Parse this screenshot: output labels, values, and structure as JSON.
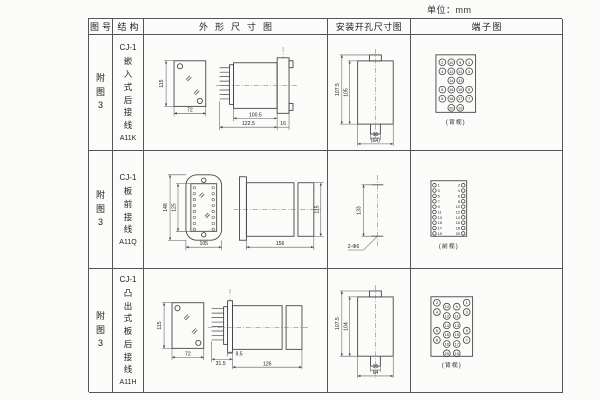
{
  "unit_label": "单位：mm",
  "table": {
    "headers": [
      "图号",
      "结构",
      "外形尺寸图",
      "安装开孔尺寸图",
      "端子图"
    ],
    "rows": [
      {
        "figure_no": "附图3",
        "structure": {
          "series": "CJ-1",
          "mount": "嵌入式后接线",
          "model": "A11K"
        },
        "outline": {
          "front_height": "115",
          "front_width": "72",
          "body_depth": "100.5",
          "total_depth": "122.5",
          "flange_depth": "16"
        },
        "mounting": {
          "outer_height": "107.5",
          "inner_height": "105",
          "slot_width": "16",
          "opening_width": "(64)"
        },
        "terminal": {
          "view_label": "(背视)",
          "grid": [
            [
              "2",
              "10",
              "9",
              "1"
            ],
            [
              "4",
              "12",
              "11",
              "3"
            ],
            [
              "",
              "14",
              "13",
              ""
            ],
            [
              "6",
              "16",
              "15",
              "5"
            ],
            [
              "8",
              "18",
              "17",
              "7"
            ],
            [
              "",
              "20",
              "19",
              ""
            ]
          ]
        }
      },
      {
        "figure_no": "附图3",
        "structure": {
          "series": "CJ-1",
          "mount": "板前接线",
          "model": "A11Q"
        },
        "outline": {
          "outer_height": "148",
          "inner_height": "125",
          "width": "105",
          "depth": "156",
          "side_height": "115"
        },
        "mounting": {
          "hole_spacing": "133",
          "hole_note": "2-Φ6"
        },
        "terminal": {
          "view_label": "(前视)",
          "pairs": [
            [
              "1",
              "2"
            ],
            [
              "3",
              "4"
            ],
            [
              "5",
              "6"
            ],
            [
              "7",
              "8"
            ],
            [
              "9",
              "10"
            ],
            [
              "11",
              "12"
            ],
            [
              "13",
              "14"
            ],
            [
              "15",
              "16"
            ],
            [
              "17",
              "18"
            ],
            [
              "19",
              "20"
            ]
          ]
        }
      },
      {
        "figure_no": "附图3",
        "structure": {
          "series": "CJ-1",
          "mount": "凸出式板后接线",
          "model": "A11H"
        },
        "outline": {
          "front_height": "115",
          "front_width": "72",
          "pin_depth": "31.5",
          "plate_depth": "9.5",
          "body_depth": "126"
        },
        "mounting": {
          "outer_height": "107.5",
          "inner_height": "104",
          "slot_width": "16",
          "opening_width": "64"
        },
        "terminal": {
          "view_label": "(背视)",
          "grid": [
            [
              "2",
              "10",
              "9",
              "1"
            ],
            [
              "4",
              "12",
              "11",
              "3"
            ],
            [
              "",
              "14",
              "13",
              ""
            ],
            [
              "6",
              "16",
              "15",
              "5"
            ],
            [
              "8",
              "18",
              "17",
              "7"
            ],
            [
              "",
              "20",
              "19",
              ""
            ]
          ]
        }
      }
    ]
  }
}
